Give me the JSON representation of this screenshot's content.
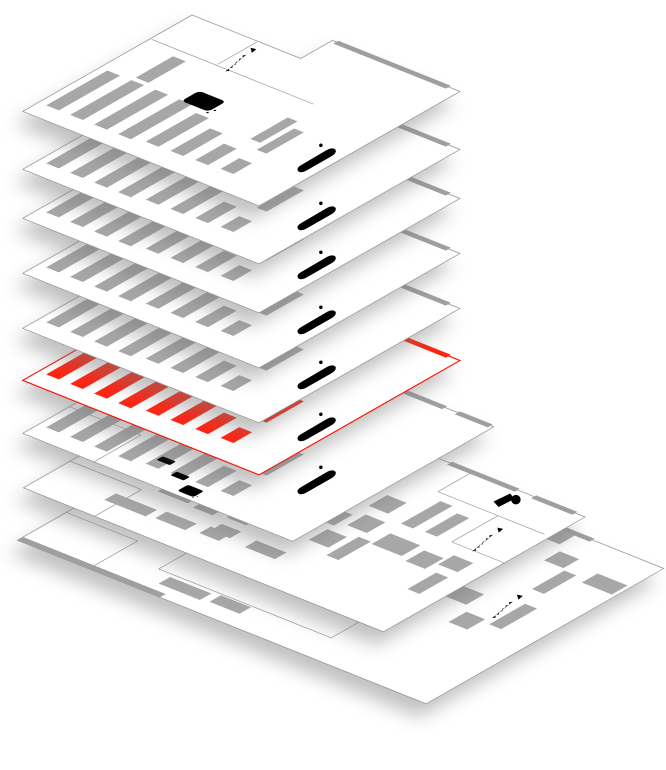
{
  "diagram": {
    "type": "isometric-floor-stack",
    "subject": "exploded isometric view of building levels with one level highlighted",
    "floor_count": 9,
    "highlighted_floor_id": "floor-6",
    "colors": {
      "background": "#ffffff",
      "floor_fill": "#ffffff",
      "gray_outline": "#9b9b9b",
      "gray_furniture": "#a7a7a7",
      "highlight_red": "#ff2412",
      "highlight_red_outline": "#fb1407",
      "icon_stroke": "#3c3c3c"
    },
    "floors": [
      {
        "id": "floor-1",
        "plan": "small-retail",
        "state": "default",
        "icons": [
          "stairs-icon",
          "restroom-icon",
          "escalator-icon"
        ],
        "shelf_bars": 11
      },
      {
        "id": "floor-2",
        "plan": "small-retail",
        "state": "default",
        "icons": [
          "stairs-icon",
          "restroom-icon",
          "escalator-icon"
        ],
        "shelf_bars": 11
      },
      {
        "id": "floor-3",
        "plan": "small-retail",
        "state": "default",
        "icons": [
          "stairs-icon",
          "restroom-icon",
          "escalator-icon"
        ],
        "shelf_bars": 11
      },
      {
        "id": "floor-4",
        "plan": "small-retail",
        "state": "default",
        "icons": [
          "stairs-icon",
          "restroom-icon",
          "escalator-icon"
        ],
        "shelf_bars": 11
      },
      {
        "id": "floor-5",
        "plan": "small-retail",
        "state": "default",
        "icons": [
          "stairs-icon",
          "restroom-icon",
          "escalator-icon"
        ],
        "shelf_bars": 11
      },
      {
        "id": "floor-6",
        "plan": "small-retail",
        "state": "highlighted",
        "icons": [
          "stairs-icon",
          "restroom-icon",
          "escalator-icon"
        ],
        "shelf_bars": 11
      },
      {
        "id": "floor-7",
        "plan": "medium-retail",
        "state": "default",
        "icons": [
          "stairs-icon",
          "restroom-icon",
          "escalator-icon",
          "door-swing-icon",
          "table-icon",
          "mini-restroom-icon"
        ],
        "shelf_bars": 11
      },
      {
        "id": "floor-8",
        "plan": "large-hall-upper",
        "state": "default",
        "icons": [
          "camera-icon",
          "stairs-icon"
        ],
        "display_blocks": 37
      },
      {
        "id": "floor-9",
        "plan": "large-hall-lower",
        "state": "default",
        "icons": [
          "stairs-icon"
        ],
        "display_blocks": 25
      }
    ]
  }
}
